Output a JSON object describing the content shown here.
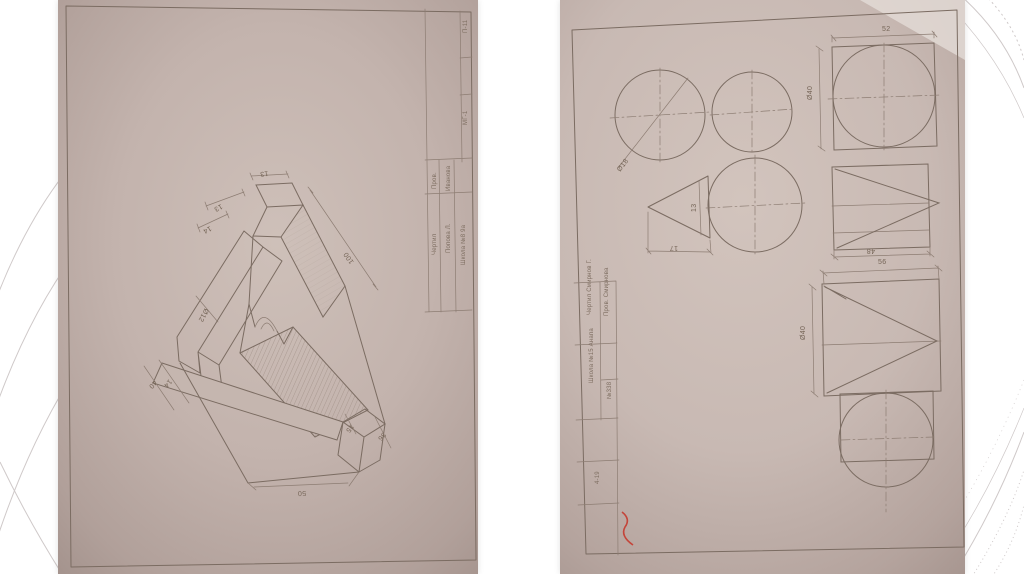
{
  "slide": {
    "background": "#ffffff",
    "arc_color": "#cfc9c9",
    "paper_color": "#c6b7b0",
    "pencil_color": "#7b6c62",
    "red_mark_color": "#c4453a"
  },
  "photo_a": {
    "description": "pencil isometric drawing of stepped machined bracket with half-round notch",
    "dims": {
      "d13_top": "13",
      "d13_left": "13",
      "d14_left": "14",
      "dia12": "Ø12",
      "d100": "100",
      "d40": "40",
      "d14_low": "14",
      "d15": "15",
      "d36": "36",
      "d50": "50"
    },
    "title_block": {
      "corner_top": "П-11",
      "corner_mid": "МГ-1",
      "row1_label": "Чертил",
      "row1_value": "Попова Л.",
      "row2_label": "Пров.",
      "row2_value": "Иванова",
      "note": "Школа №8 9а"
    }
  },
  "photo_b": {
    "description": "pencil orthographic projections of solids: circles, cone triangle, cylinder and prism views",
    "dims": {
      "dia18": "Ø18",
      "d13": "13",
      "d17": "17",
      "d52": "52",
      "dia40_top": "Ø40",
      "d48": "48",
      "d56": "56",
      "dia40_bot": "Ø40"
    },
    "title_block": {
      "row1": "Чертил Смирнов Г.",
      "row2": "Пров. Смирнова",
      "note": "Школа №15 Анапа",
      "code": "№338",
      "bottom": "4-19"
    }
  }
}
